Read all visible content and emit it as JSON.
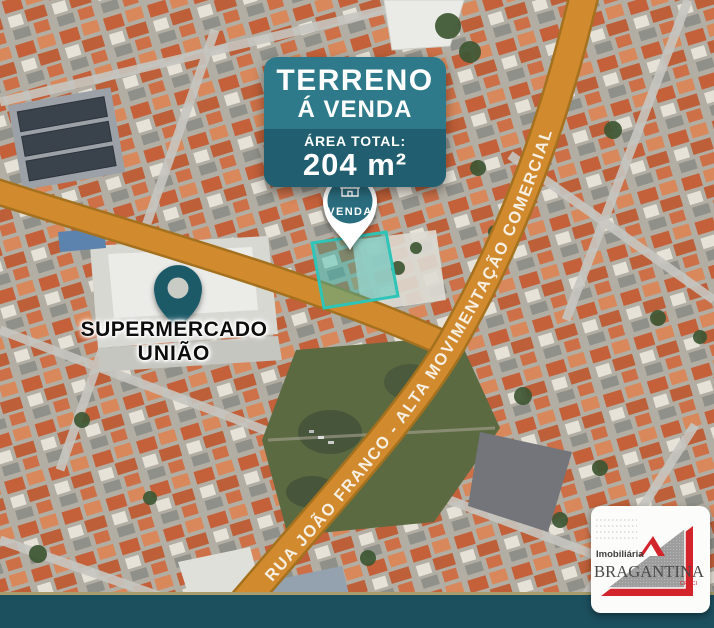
{
  "banner": {
    "title": "TERRENO",
    "subtitle": "Á VENDA",
    "area_label": "ÁREA TOTAL:",
    "area_value": "204 m²"
  },
  "venda_pin": {
    "label": "VENDA"
  },
  "supermarket": {
    "line1": "SUPERMERCADO",
    "line2": "UNIÃO"
  },
  "road": {
    "label": "RUA JOÃO FRANCO - ALTA MOVIMENTAÇÃO COMERCIAL"
  },
  "logo": {
    "sector": "Imobiliária",
    "name": "BRAGANTINA",
    "registry": "CRECI"
  },
  "colors": {
    "banner_teal": "#2e7a8a",
    "banner_dark_teal": "#215f70",
    "road_orange": "#d18a2e",
    "road_edge": "#a4711f",
    "lot_teal": "#2fc4b8",
    "pin_teal": "#2a6d7e",
    "supermarket_pin": "#1d5a68",
    "bottom_bar": "#1d505f",
    "bottom_bar_border": "#a89b6c",
    "logo_red": "#d3232b"
  }
}
